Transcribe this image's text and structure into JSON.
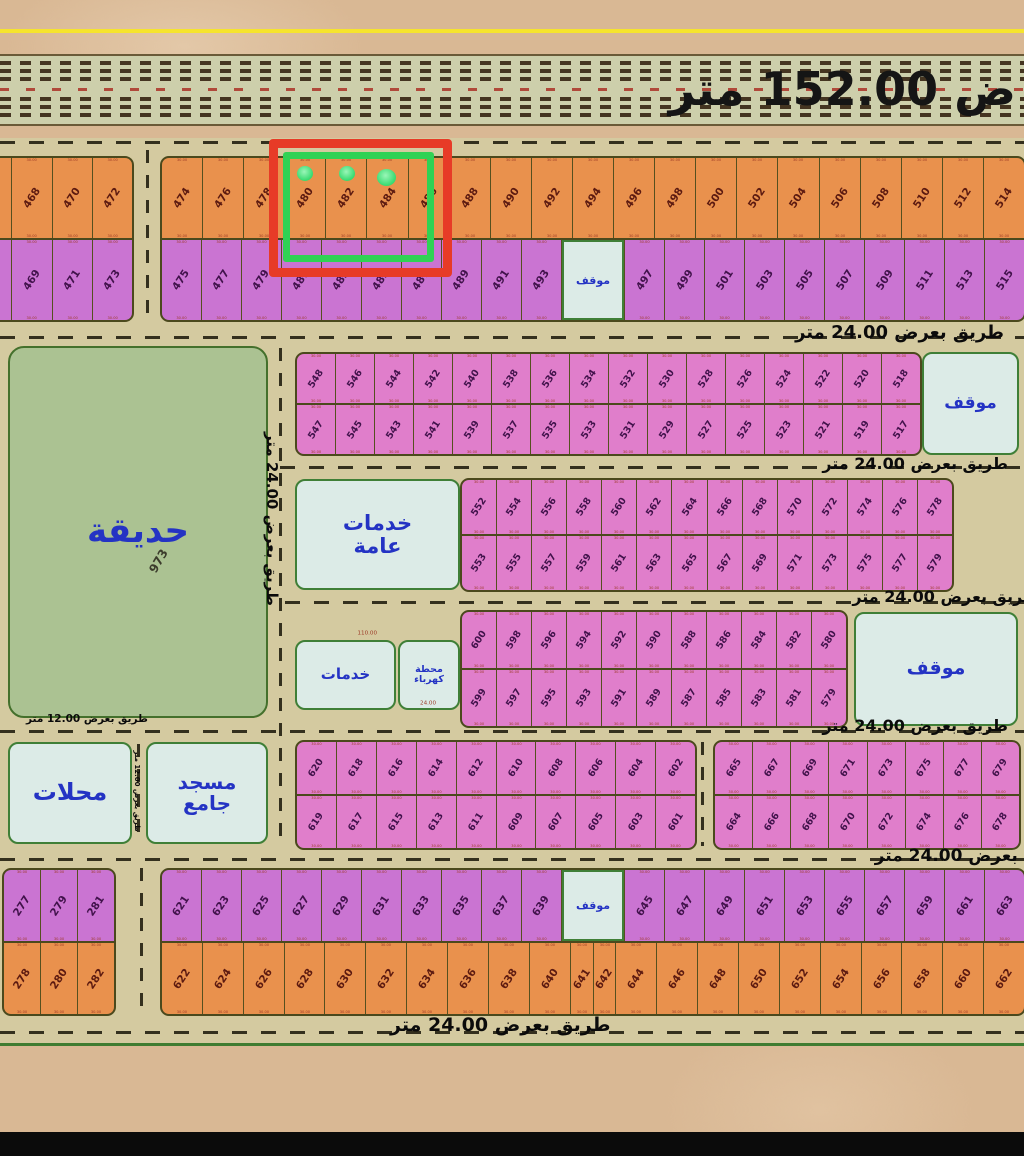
{
  "highway": {
    "label": "ض 152.00 متر"
  },
  "road_labels": {
    "r24": "طريق بعرض 24.00 متر",
    "r12": "طريق بعرض 12.00 متر",
    "v24": "طريق بعرض 24.00 متر",
    "v12": "طريق بعرض 12.00 متر"
  },
  "areas": {
    "park": {
      "label": "حديقة",
      "num": "973"
    },
    "services_big": {
      "label": "خدمات عامة"
    },
    "services_small": {
      "label": "خدمات"
    },
    "power": {
      "label": "محطة كهرباء",
      "dim": "24.00"
    },
    "shops": {
      "label": "محلات"
    },
    "mosque": {
      "label": "مسجد جامع"
    },
    "parking": {
      "label": "موقف"
    }
  },
  "dim": "30.00",
  "strip_dim": "110.00",
  "colors": {
    "orange": "#e9914d",
    "pink": "#e07ecb",
    "purple": "#ca74d2",
    "orange_num": "#5c1a10",
    "pink_num": "#41124b",
    "purple_num": "#41124b",
    "highlight_red": "#e73b27",
    "highlight_green": "#2fd254",
    "park_green": "#abc292",
    "service_blue": "#dcebe7",
    "label_blue": "#2433c4"
  },
  "highlight": {
    "plots": [
      "480",
      "482",
      "484"
    ]
  },
  "blocks": {
    "b1L": {
      "top": {
        "color": "orange",
        "cells": [
          "",
          "468",
          "470",
          "472"
        ]
      },
      "bottom": {
        "color": "purple",
        "cells": [
          "",
          "469",
          "471",
          "473"
        ]
      }
    },
    "b1M": {
      "top": {
        "color": "orange",
        "cells": [
          "474",
          "476",
          "478",
          "480",
          "482",
          "484",
          "486",
          "488",
          "490",
          "492",
          "494",
          "496",
          "498",
          "500",
          "502",
          "504",
          "506",
          "508",
          "510",
          "512",
          "514"
        ]
      },
      "bottom": {
        "color": "purple",
        "cells": [
          "475",
          "477",
          "479",
          "481",
          "483",
          "485",
          "487",
          "489",
          "491",
          "493",
          {
            "n": "P",
            "f": 1.6
          },
          "497",
          "499",
          "501",
          "503",
          "505",
          "507",
          "509",
          "511",
          "513",
          "515"
        ]
      }
    },
    "b2": {
      "top": {
        "color": "pink",
        "cells": [
          "548",
          "546",
          "544",
          "542",
          "540",
          "538",
          "536",
          "534",
          "532",
          "530",
          "528",
          "526",
          "524",
          "522",
          "520",
          "518"
        ]
      },
      "bottom": {
        "color": "pink",
        "cells": [
          "547",
          "545",
          "543",
          "541",
          "539",
          "537",
          "535",
          "533",
          "531",
          "529",
          "527",
          "525",
          "523",
          "521",
          "519",
          "517"
        ]
      }
    },
    "b3": {
      "top": {
        "color": "pink",
        "cells": [
          "552",
          "554",
          "556",
          "558",
          "560",
          "562",
          "564",
          "566",
          "568",
          "570",
          "572",
          "574",
          "576",
          "578"
        ]
      },
      "bottom": {
        "color": "pink",
        "cells": [
          "553",
          "555",
          "557",
          "559",
          "561",
          "563",
          "565",
          "567",
          "569",
          "571",
          "573",
          "575",
          "577",
          "579"
        ]
      }
    },
    "b4": {
      "top": {
        "color": "pink",
        "cells": [
          "600",
          "598",
          "596",
          "594",
          "592",
          "590",
          "588",
          "586",
          "584",
          "582",
          "580"
        ]
      },
      "bottom": {
        "color": "pink",
        "cells": [
          "599",
          "597",
          "595",
          "593",
          "591",
          "589",
          "587",
          "585",
          "583",
          "581",
          "579"
        ]
      }
    },
    "b5A": {
      "top": {
        "color": "pink",
        "cells": [
          "620",
          "618",
          "616",
          "614",
          "612",
          "610",
          "608",
          "606",
          "604",
          "602"
        ]
      },
      "bottom": {
        "color": "pink",
        "cells": [
          "619",
          "617",
          "615",
          "613",
          "611",
          "609",
          "607",
          "605",
          "603",
          "601"
        ]
      }
    },
    "b5B": {
      "top": {
        "color": "pink",
        "cells": [
          "665",
          "667",
          "669",
          "671",
          "673",
          "675",
          "677",
          "679"
        ]
      },
      "bottom": {
        "color": "pink",
        "cells": [
          "664",
          "666",
          "668",
          "670",
          "672",
          "674",
          "676",
          "678"
        ]
      }
    },
    "b6L": {
      "top": {
        "color": "purple",
        "cells": [
          "277",
          "279",
          "281"
        ]
      },
      "bottom": {
        "color": "orange",
        "cells": [
          "278",
          "280",
          "282"
        ]
      }
    },
    "b6M": {
      "top": {
        "color": "purple",
        "cells": [
          "621",
          "623",
          "625",
          "627",
          "629",
          "631",
          "633",
          "635",
          "637",
          "639",
          {
            "n": "P",
            "f": 1.6
          },
          "645",
          "647",
          "649",
          "651",
          "653",
          "655",
          "657",
          "659",
          "661",
          "663"
        ]
      },
      "bottom": {
        "color": "orange",
        "cells": [
          "622",
          "624",
          "626",
          "628",
          "630",
          "632",
          "634",
          "636",
          "638",
          "640",
          {
            "n": "641",
            "f": 0.55
          },
          {
            "n": "642",
            "f": 0.55
          },
          "644",
          "646",
          "648",
          "650",
          "652",
          "654",
          "656",
          "658",
          "660",
          "662"
        ]
      }
    }
  }
}
